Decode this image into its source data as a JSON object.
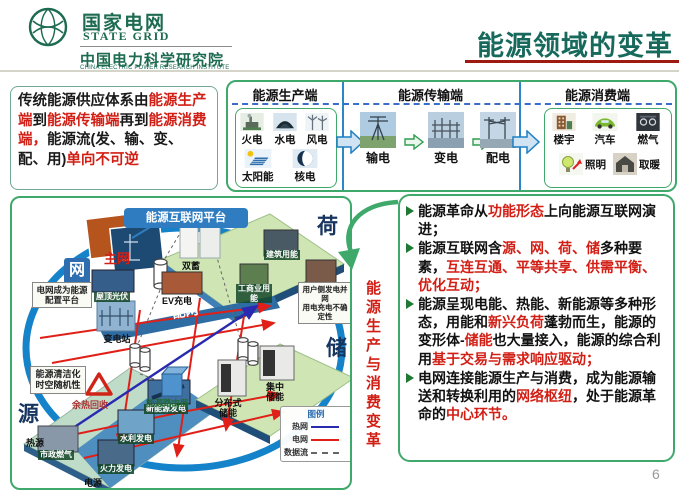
{
  "header": {
    "brand_cn": "国家电网",
    "brand_en": "STATE GRID",
    "institute_cn": "中国电力科学研究院",
    "institute_en": "CHINA ELECTRIC POWER RESEARCH INSTITUTE",
    "title": "能源领域的变革"
  },
  "intro": {
    "segments": [
      {
        "t": "传统能源供应体系由",
        "c": "k"
      },
      {
        "t": "能源生产端",
        "c": "r"
      },
      {
        "t": "到",
        "c": "k"
      },
      {
        "t": "能源传输端",
        "c": "r"
      },
      {
        "t": "再到",
        "c": "k"
      },
      {
        "t": "能源消费端，",
        "c": "r"
      },
      {
        "t": "能源流(发、输、变、配、用)",
        "c": "k"
      },
      {
        "t": "单向不可逆",
        "c": "r"
      }
    ]
  },
  "flow": {
    "sections": [
      {
        "title": "能源生产端"
      },
      {
        "title": "能源传输端"
      },
      {
        "title": "能源消费端"
      }
    ],
    "production": {
      "items": [
        {
          "label": "火电",
          "icon": "thermal-power-icon"
        },
        {
          "label": "水电",
          "icon": "hydro-power-icon"
        },
        {
          "label": "风电",
          "icon": "wind-power-icon"
        },
        {
          "label": "太阳能",
          "icon": "solar-power-icon"
        },
        {
          "label": "核电",
          "icon": "nuclear-power-icon"
        }
      ]
    },
    "transmission": {
      "items": [
        {
          "label": "输电",
          "icon": "transmission-tower-icon"
        },
        {
          "label": "变电",
          "icon": "substation-icon"
        },
        {
          "label": "配电",
          "icon": "distribution-icon"
        }
      ]
    },
    "consumption": {
      "items": [
        {
          "label": "楼宇",
          "icon": "building-icon"
        },
        {
          "label": "汽车",
          "icon": "car-icon"
        },
        {
          "label": "燃气",
          "icon": "gas-icon"
        },
        {
          "label": "照明",
          "icon": "lighting-icon"
        },
        {
          "label": "取暖",
          "icon": "heating-icon"
        }
      ]
    }
  },
  "diagram": {
    "platform_title": "能源互联网平台",
    "main_grid": "主网",
    "dist_grid": "配网",
    "node_net": "网",
    "node_source": "源",
    "node_load": "荷",
    "node_storage": "储",
    "callout_grid_platform": "电网成为能源配置平台",
    "callout_clean_line1": "能源清洁化",
    "callout_clean_line2": "时空随机性",
    "callout_user_line1": "用户侧发电并网",
    "callout_user_line2": "用电充电不确定性",
    "substation": "变电站",
    "energy_router": "能源路由器",
    "load_items": {
      "dual_storage": "双蓄",
      "building_energy": "建筑用能",
      "resident_energy": "居民用能",
      "industry_energy": "工商业用能",
      "rooftop_pv": "屋顶光伏",
      "ev_charging": "EV充电"
    },
    "source_items": {
      "waste_heat": "余热回收",
      "city_gas": "市政燃气",
      "thermal_gen": "火力发电",
      "hydro_gen": "水利发电",
      "new_energy_gen": "新能源发电",
      "heat_source": "热源",
      "power_source": "电源"
    },
    "storage_items": {
      "distributed": "分布式储能",
      "centralized": "集中储能"
    },
    "legend": {
      "title": "图例",
      "heat_net": "热网",
      "power_net": "电网",
      "data_flow": "数据流"
    }
  },
  "middle": {
    "vertical_text": "能源生产与消费变革"
  },
  "bullets": [
    {
      "segments": [
        {
          "t": "能源革命从",
          "c": "k"
        },
        {
          "t": "功能形态",
          "c": "r"
        },
        {
          "t": "上向能源互联网演进；",
          "c": "k"
        }
      ]
    },
    {
      "segments": [
        {
          "t": "能源互联网含",
          "c": "k"
        },
        {
          "t": "源、网、荷、储",
          "c": "r"
        },
        {
          "t": "多种要素，",
          "c": "k"
        },
        {
          "t": "互连互通、平等共享、供需平衡、优化互动；",
          "c": "r"
        }
      ]
    },
    {
      "segments": [
        {
          "t": "能源呈现电能、热能、新能源等多种形态，用能和",
          "c": "k"
        },
        {
          "t": "新兴负荷",
          "c": "r"
        },
        {
          "t": "蓬勃而生，能源的变形体-",
          "c": "k"
        },
        {
          "t": "储能",
          "c": "r"
        },
        {
          "t": "也大量接入，能源的综合利用",
          "c": "k"
        },
        {
          "t": "基于交易与需求响应驱动；",
          "c": "r"
        }
      ]
    },
    {
      "segments": [
        {
          "t": "电网连接能源生产与消费，成为能源输送和转换利用的",
          "c": "k"
        },
        {
          "t": "网络枢纽",
          "c": "r"
        },
        {
          "t": "，处于能源革命的",
          "c": "k"
        },
        {
          "t": "中心环节。",
          "c": "r"
        }
      ]
    }
  ],
  "page": {
    "number": "6"
  }
}
